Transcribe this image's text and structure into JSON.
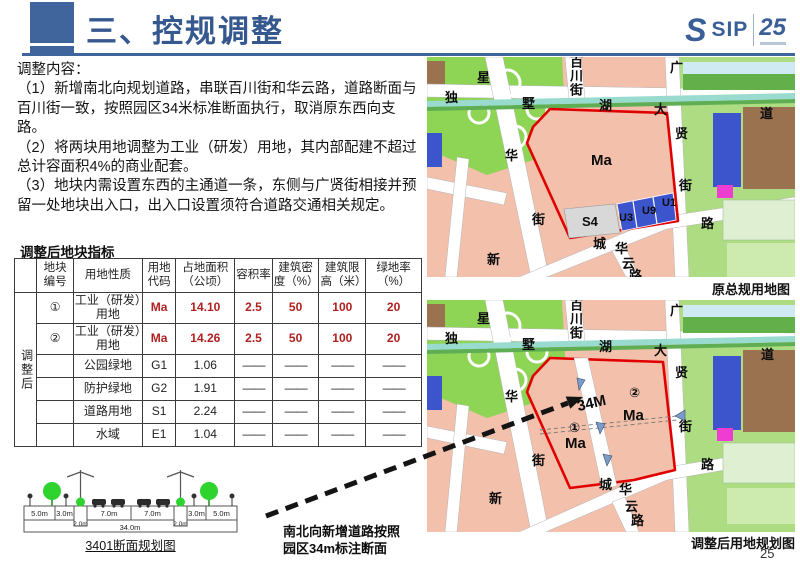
{
  "page": {
    "number": "25"
  },
  "header": {
    "title": "三、控规调整",
    "logo": {
      "mark": "S",
      "text": "SIP",
      "anniversary": "25"
    }
  },
  "content": {
    "heading": "调整内容：",
    "items": [
      "（1）新增南北向规划道路，串联百川街和华云路，道路断面与百川街一致，按照园区34米标准断面执行，取消原东西向支路。",
      "（2）将两块用地调整为工业（研发）用地，其内部配建不超过总计容面积4%的商业配套。",
      "（3）地块内需设置东西的主通道一条，东侧与广贤街相接并预留一处地块出入口，出入口设置须符合道路交通相关规定。"
    ]
  },
  "table": {
    "title": "调整后地块指标",
    "group_label": "调整后",
    "headers": [
      "地块编号",
      "用地性质",
      "用地代码",
      "占地面积（公顷）",
      "容积率",
      "建筑密度（%）",
      "建筑限高（米）",
      "绿地率（%）"
    ],
    "rows": [
      {
        "no": "①",
        "nature": "工业（研发）用地",
        "code": "Ma",
        "area": "14.10",
        "far": "2.5",
        "density": "50",
        "height": "100",
        "green": "20"
      },
      {
        "no": "②",
        "nature": "工业（研发）用地",
        "code": "Ma",
        "area": "14.26",
        "far": "2.5",
        "density": "50",
        "height": "100",
        "green": "20"
      },
      {
        "no": "",
        "nature": "公园绿地",
        "code": "G1",
        "area": "1.06",
        "far": "——",
        "density": "——",
        "height": "——",
        "green": "——"
      },
      {
        "no": "",
        "nature": "防护绿地",
        "code": "G2",
        "area": "1.91",
        "far": "——",
        "density": "——",
        "height": "——",
        "green": "——"
      },
      {
        "no": "",
        "nature": "道路用地",
        "code": "S1",
        "area": "2.24",
        "far": "——",
        "density": "——",
        "height": "——",
        "green": "——"
      },
      {
        "no": "",
        "nature": "水域",
        "code": "E1",
        "area": "1.04",
        "far": "——",
        "density": "——",
        "height": "——",
        "green": "——"
      }
    ]
  },
  "section_diagram": {
    "caption": "3401断面规划图",
    "widths": [
      "5.0m",
      "3.0m",
      "2.0m",
      "7.0m",
      "7.0m",
      "2.0m",
      "3.0m",
      "5.0m"
    ],
    "total": "34.0m"
  },
  "annotation": {
    "line1": "南北向新增道路按照",
    "line2": "园区34m标注断面"
  },
  "maps": {
    "top": {
      "caption": "原总规用地图",
      "labels": {
        "xing": "星",
        "du": "独",
        "shu": "墅",
        "baichuanjie": "百川街",
        "hu": "湖",
        "da": "大",
        "guang": "广",
        "dao": "道",
        "xian": "贤",
        "jie_right": "街",
        "lu_right": "路",
        "hua_left": "华",
        "jie_left": "街",
        "xin": "新",
        "cheng": "城",
        "hua_bottom": "华",
        "yun": "云",
        "lu_bottom": "路",
        "ma": "Ma",
        "s4": "S4",
        "u3": "U3",
        "u9": "U9",
        "u1": "U1"
      }
    },
    "bottom": {
      "caption": "调整后用地规划图",
      "labels": {
        "xing": "星",
        "du": "独",
        "shu": "墅",
        "baichuanjie": "百川街",
        "hu": "湖",
        "da": "大",
        "guang": "广",
        "dao": "道",
        "xian": "贤",
        "jie_right": "街",
        "lu_right": "路",
        "hua_left": "华",
        "jie_left": "街",
        "xin": "新",
        "cheng": "城",
        "hua_bottom": "华",
        "yun": "云",
        "lu_bottom": "路",
        "road_width": "34M",
        "plot1_no": "①",
        "plot1_code": "Ma",
        "plot2_no": "②",
        "plot2_code": "Ma"
      }
    }
  },
  "colors": {
    "header_blue": "#40659c",
    "title_blue": "#35588e",
    "value_red": "#b02020",
    "parcel_salmon": "#f2c0ab",
    "parcel_blue": "#3d55cc",
    "parcel_gray": "#d8d8d8",
    "boundary_red": "#e00000",
    "map_green": "#aedc82"
  }
}
